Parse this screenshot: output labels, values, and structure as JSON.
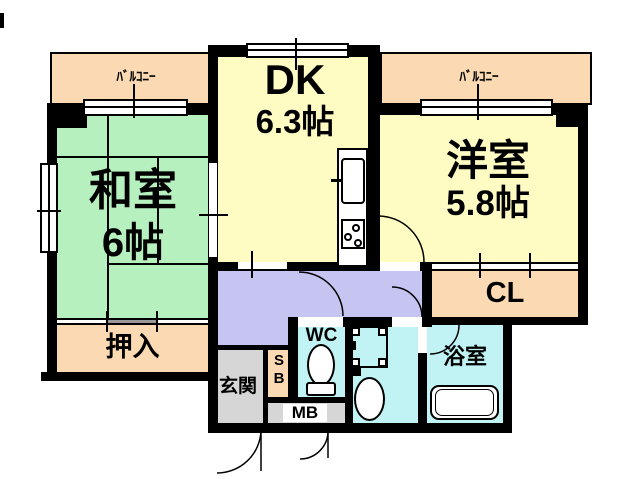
{
  "floorplan": {
    "rooms": {
      "balcony_left": {
        "label": "ﾊﾞﾙｺﾆｰ"
      },
      "balcony_right": {
        "label": "ﾊﾞﾙｺﾆｰ"
      },
      "dining_kitchen": {
        "label": "DK",
        "size": "6.3帖"
      },
      "western_room": {
        "label": "洋室",
        "size": "5.8帖"
      },
      "japanese_room": {
        "label": "和室",
        "size": "6帖"
      },
      "closet_oshiire": {
        "label": "押入"
      },
      "closet_cl": {
        "label": "CL"
      },
      "toilet": {
        "label": "WC"
      },
      "bathroom": {
        "label": "浴室"
      },
      "entrance": {
        "label": "玄関"
      },
      "shoe_box": {
        "label": "SB"
      },
      "meter_box": {
        "label": "MB"
      }
    },
    "colors": {
      "bg": "#FFFFFF",
      "wall": "#000000",
      "peach": "#FBD9B3",
      "green": "#B6F0BF",
      "yellow": "#FFFCC3",
      "purple": "#C6C4F1",
      "cyan": "#C2F3F4",
      "gray": "#D6D6D6",
      "slide": "#999999"
    }
  }
}
